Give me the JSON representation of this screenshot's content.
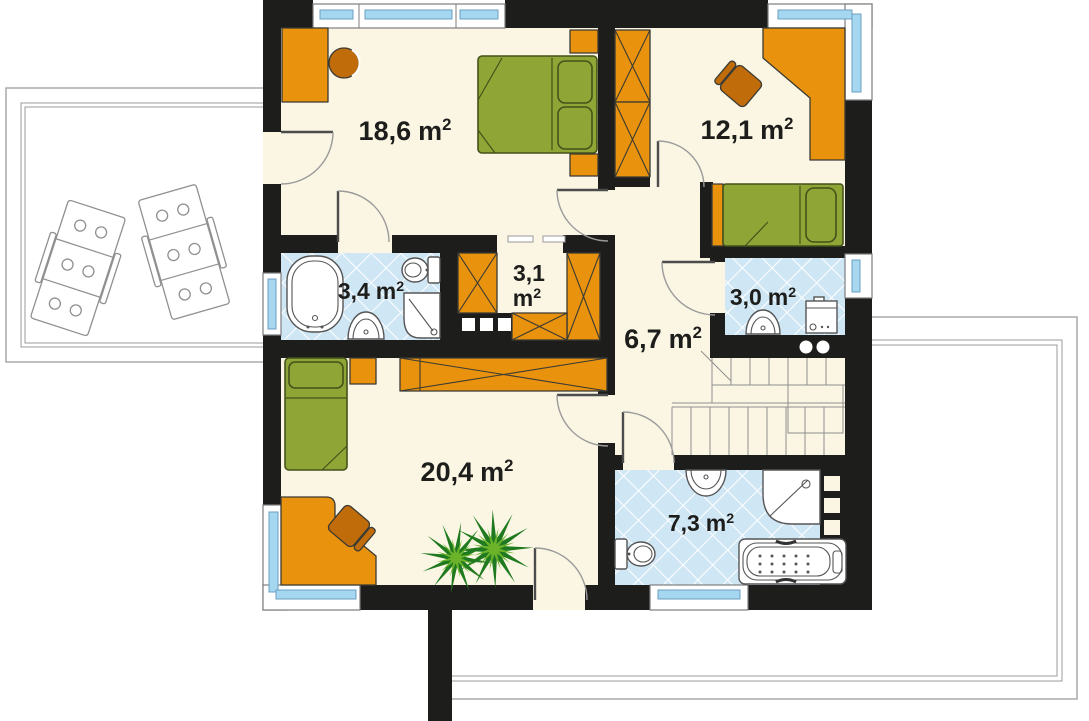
{
  "plan": {
    "rooms": [
      {
        "name": "bedroom-large",
        "area": "18,6",
        "unit": "m",
        "sup": "2"
      },
      {
        "name": "bedroom-right",
        "area": "12,1",
        "unit": "m",
        "sup": "2"
      },
      {
        "name": "bathroom-ensuite",
        "area": "3,4",
        "unit": "m",
        "sup": "2"
      },
      {
        "name": "wardrobe-closet",
        "area": "3,1",
        "unit": "m",
        "sup": "2"
      },
      {
        "name": "bathroom-small",
        "area": "3,0",
        "unit": "m",
        "sup": "2"
      },
      {
        "name": "hallway",
        "area": "6,7",
        "unit": "m",
        "sup": "2"
      },
      {
        "name": "bedroom-bottom",
        "area": "20,4",
        "unit": "m",
        "sup": "2"
      },
      {
        "name": "bathroom-main",
        "area": "7,3",
        "unit": "m",
        "sup": "2"
      }
    ],
    "colors": {
      "background": "#ffffff",
      "wall": "#1d1d1b",
      "floor": "#faf6e3",
      "furniture": "#e9920e",
      "furniture_dark": "#c06c0a",
      "bed": "#8fa637",
      "bed_outline": "#44511a",
      "tile": "#cfe6f5",
      "tile_line": "#ffffff",
      "glass": "#a5d7f1",
      "frame_line": "#7d7d7d",
      "outline": "#3a3a34",
      "fixture_line": "#555555",
      "terrace_line": "#9b9b9b",
      "label": "#1d1d1b",
      "plant_dark": "#1f7a1f",
      "plant_light": "#6cb32a"
    }
  }
}
